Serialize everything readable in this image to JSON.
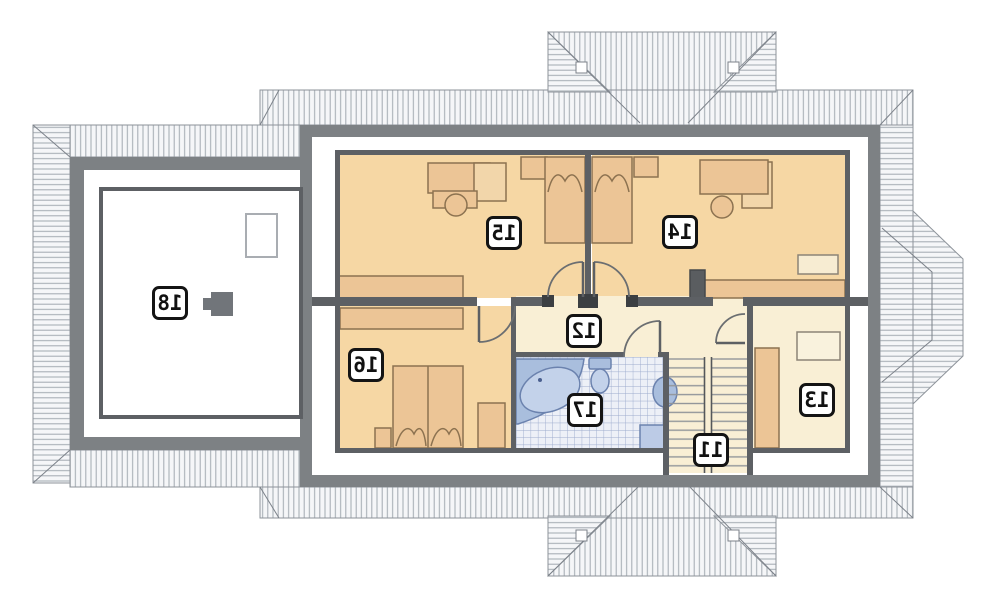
{
  "plan": {
    "type": "floor-plan",
    "mirrored": true,
    "room_labels": {
      "r11": "11",
      "r12": "12",
      "r13": "13",
      "r14": "14",
      "r15": "15",
      "r16": "16",
      "r17": "17",
      "r18": "18"
    },
    "icons": {
      "room18_equipment": "equipment-icon"
    },
    "colors": {
      "roof_hatch_bg": "#f5f6f8",
      "roof_hatch_line": "#a9afb6",
      "roof_edge": "#8d939a",
      "outer_wall_gray": "#7d8184",
      "inner_wall_gray": "#5d6064",
      "room_peach": "#f6d7a4",
      "room_cream": "#f9efd5",
      "furniture_tan": "#ecc596",
      "furniture_tan_light": "#f2d6aa",
      "bath_fixture_blue": "#a9bedd",
      "bath_fixture_blue_light": "#c3d2ea",
      "tile_bg": "#edf0f7",
      "tile_line": "#9cabcd",
      "label_border": "#141414"
    }
  }
}
